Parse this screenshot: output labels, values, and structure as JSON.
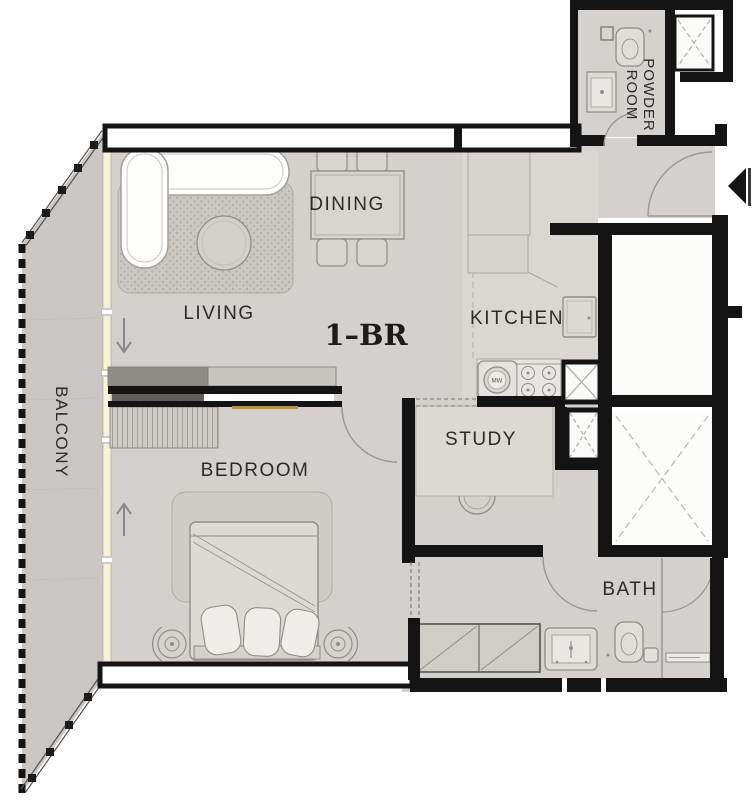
{
  "plan": {
    "unit_type_label": "1–BR",
    "rooms": {
      "living": {
        "label": "LIVING"
      },
      "dining": {
        "label": "DINING"
      },
      "kitchen": {
        "label": "KITCHEN"
      },
      "bedroom": {
        "label": "BEDROOM"
      },
      "study": {
        "label": "STUDY"
      },
      "bath": {
        "label": "BATH"
      },
      "balcony": {
        "label": "BALCONY"
      },
      "powder_room": {
        "label_line1": "POWDER",
        "label_line2": "ROOM"
      }
    },
    "appliances": {
      "washer_label": "MW"
    },
    "colors": {
      "wall": "#141414",
      "floor": "#d3d0cd",
      "balcony_floor": "#c9c6c3",
      "kitchen_floor": "#dad7d3",
      "window_band": "#f5f3d8",
      "shaft_cross": "#bcb9b5",
      "accent_wood": "#b0934c"
    }
  }
}
